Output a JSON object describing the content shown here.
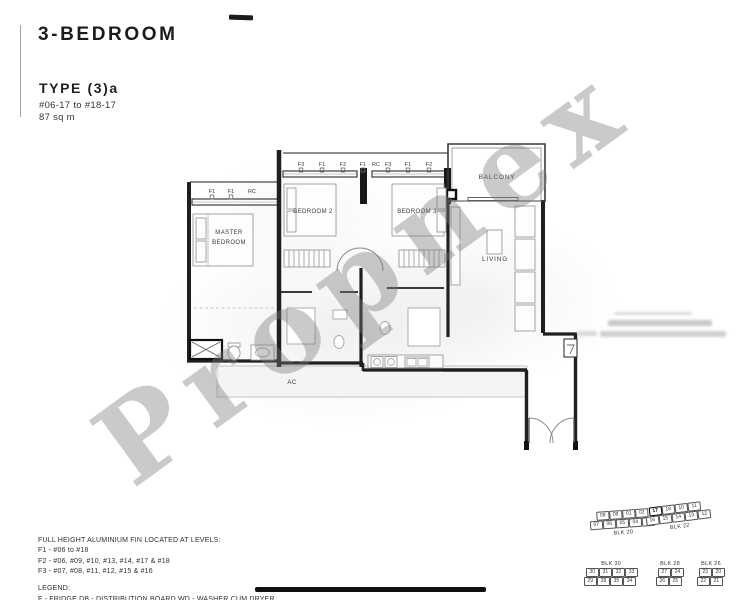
{
  "header": {
    "category": "3-BEDROOM",
    "type": "TYPE (3)a",
    "units": "#06-17 to #18-17",
    "area": "87 sq m"
  },
  "watermark": {
    "text": "Propnex"
  },
  "plan": {
    "rooms": {
      "master_line1": "MASTER",
      "master_line2": "BEDROOM",
      "bedroom2": "BEDROOM 2",
      "bedroom3": "BEDROOM 3",
      "balcony": "BALCONY",
      "living": "LIVING",
      "ac": "AC"
    },
    "fin_labels": {
      "master_row": [
        "F1",
        "F1",
        "RC"
      ],
      "mid_row": [
        "F3",
        "F1",
        "F2",
        "F1",
        "RC",
        "F3",
        "F1",
        "F2"
      ]
    }
  },
  "notes": {
    "title": "FULL HEIGHT ALUMINIUM FIN LOCATED AT LEVELS:",
    "lines": [
      "F1 - #06 to #18",
      "F2 - #06, #09, #10, #13, #14, #17 & #18",
      "F3 - #07, #08, #11, #12, #15 & #16"
    ]
  },
  "legend": {
    "title": "LEGEND:",
    "line": "F - FRIDGE   DB - DISTRIBUTION BOARD   WD - WASHER CUM DRYER"
  },
  "key_plan": {
    "highlight": {
      "block": "BLK 22",
      "unit": "17"
    },
    "blocks": [
      {
        "name": "BLK 20",
        "label_position": "below",
        "rows": [
          [
            "08",
            "09",
            "01",
            "02"
          ],
          [
            "07",
            "06",
            "05",
            "04",
            "03"
          ]
        ]
      },
      {
        "name": "BLK 22",
        "label_position": "below",
        "rows": [
          [
            "17",
            "18",
            "10",
            "11"
          ],
          [
            "16",
            "15",
            "14",
            "13",
            "12"
          ]
        ]
      },
      {
        "name": "BLK 30",
        "label_position": "above",
        "rows": [
          [
            "30",
            "31",
            "32",
            "33"
          ],
          [
            "29",
            "28",
            "35",
            "34"
          ]
        ]
      },
      {
        "name": "BLK 28",
        "label_position": "above",
        "rows": [
          [
            "27",
            "24"
          ],
          [
            "26",
            "25"
          ]
        ]
      },
      {
        "name": "BLK 26",
        "label_position": "above",
        "rows": [
          [
            "23",
            "20"
          ],
          [
            "22",
            "21"
          ]
        ]
      }
    ]
  }
}
